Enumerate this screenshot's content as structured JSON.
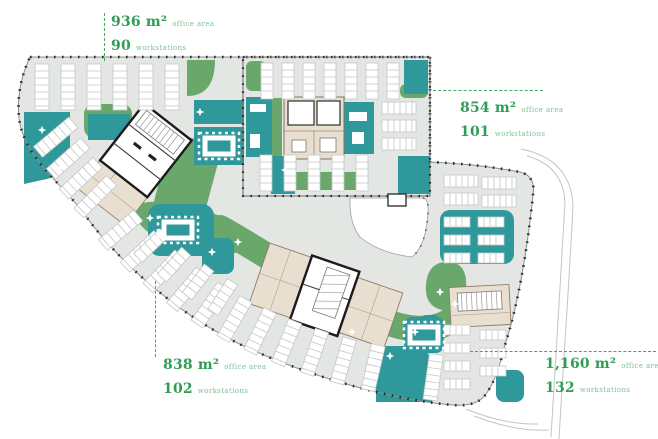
{
  "palette": {
    "accent_green": "#2f9e55",
    "label_green": "#7fbf93",
    "leader_green": "#43a763",
    "zone_green": "#69a76b",
    "room_teal": "#2e989b",
    "floor_gray": "#e3e6e3",
    "core_beige": "#e9dfd1"
  },
  "annotations": {
    "top_left": {
      "area_value": "936 m²",
      "area_label": "office area",
      "workstations_value": "90",
      "workstations_label": "workstations"
    },
    "top_right": {
      "area_value": "854 m²",
      "area_label": "office area",
      "workstations_value": "101",
      "workstations_label": "workstations"
    },
    "bottom_left": {
      "area_value": "838 m²",
      "area_label": "office area",
      "workstations_value": "102",
      "workstations_label": "workstations"
    },
    "bottom_right": {
      "area_value": "1,160 m²",
      "area_label": "office area",
      "workstations_value": "132",
      "workstations_label": "workstations"
    }
  }
}
